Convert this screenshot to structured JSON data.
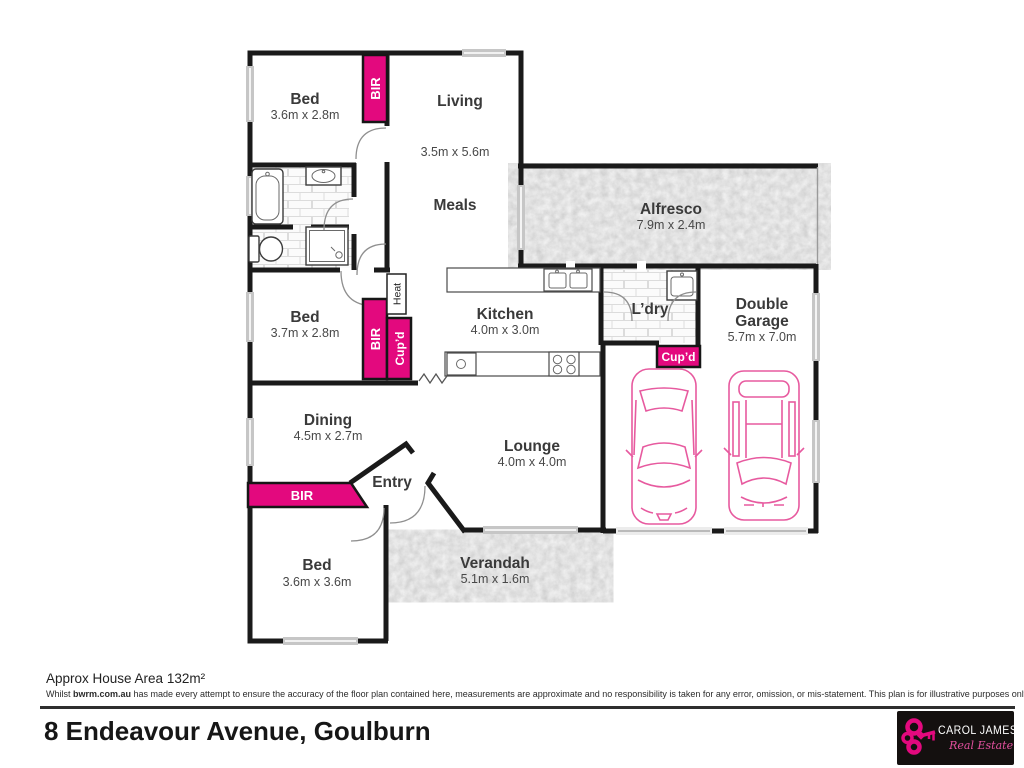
{
  "plan": {
    "rooms": {
      "bed1": {
        "name": "Bed",
        "dims": "3.6m x 2.8m"
      },
      "living": {
        "name": "Living",
        "dims": "3.5m x 5.6m"
      },
      "meals": {
        "name": "Meals"
      },
      "alfresco": {
        "name": "Alfresco",
        "dims": "7.9m x 2.4m"
      },
      "bed2": {
        "name": "Bed",
        "dims": "3.7m x 2.8m"
      },
      "kitchen": {
        "name": "Kitchen",
        "dims": "4.0m x 3.0m"
      },
      "laundry": {
        "name": "L’dry"
      },
      "garage": {
        "name_line1": "Double",
        "name_line2": "Garage",
        "dims": "5.7m x 7.0m"
      },
      "dining": {
        "name": "Dining",
        "dims": "4.5m x 2.7m"
      },
      "lounge": {
        "name": "Lounge",
        "dims": "4.0m x 4.0m"
      },
      "entry": {
        "name": "Entry"
      },
      "bed3": {
        "name": "Bed",
        "dims": "3.6m x 3.6m"
      },
      "verandah": {
        "name": "Verandah",
        "dims": "5.1m x 1.6m"
      }
    },
    "fittings": {
      "bir1": "BIR",
      "bir2": "BIR",
      "bir3": "BIR",
      "cupd1": "Cup’d",
      "cupd2": "Cup’d",
      "heat": "Heat"
    },
    "colors": {
      "accent_pink": "#e3097e",
      "wall": "#1a1a1a",
      "concrete": "#bcbcbc",
      "car_outline": "#e75a9f"
    }
  },
  "footer": {
    "area_note": "Approx House Area 132m²",
    "disclaimer": {
      "prefix": "Whilst ",
      "brand": "bwrm.com.au",
      "rest": " has made every attempt to ensure the accuracy of the floor plan contained here, measurements are approximate and no responsibility is taken for any error, omission, or mis-statement. This plan is for illustrative purposes only."
    },
    "address": "8 Endeavour Avenue, Goulburn"
  },
  "logo": {
    "brand": "CAROL JAMES",
    "tagline": "Real Estate"
  }
}
